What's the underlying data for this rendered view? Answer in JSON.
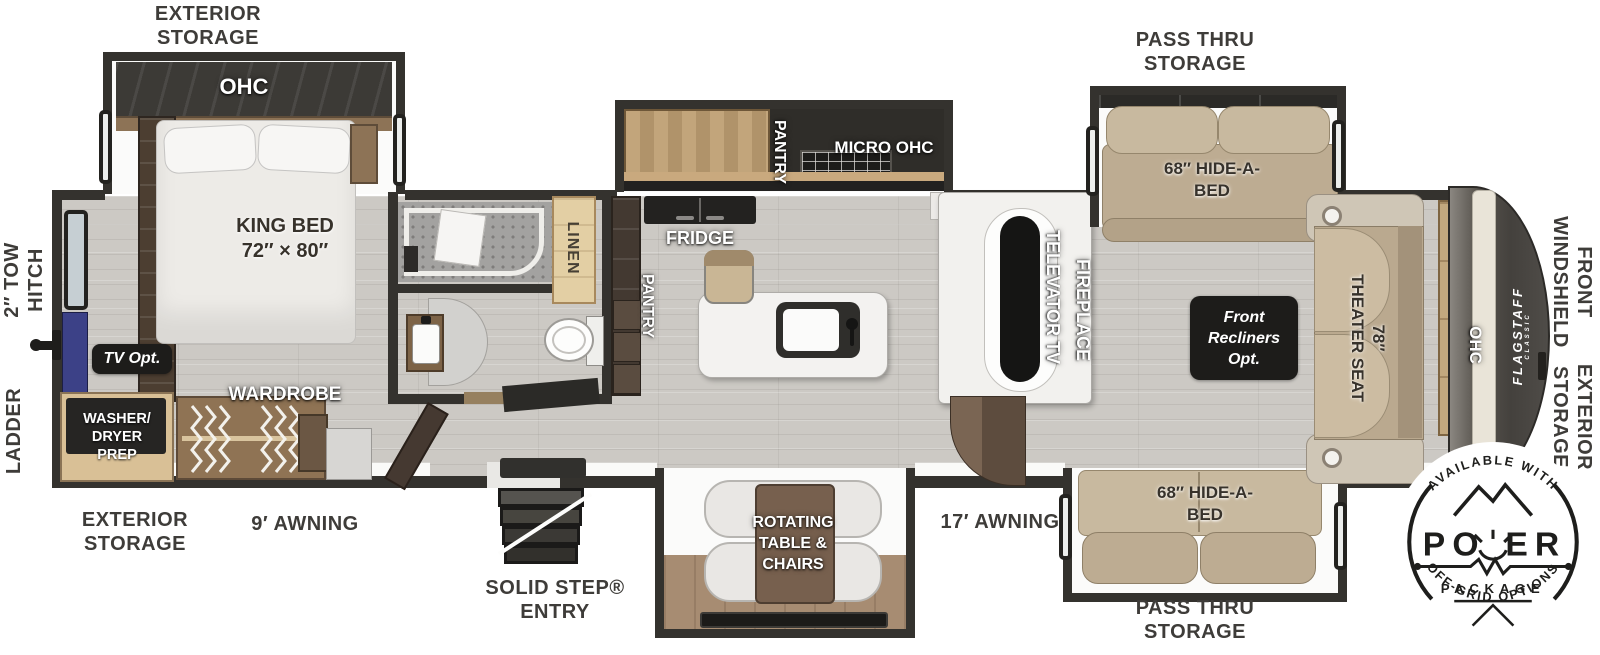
{
  "labels": {
    "exterior_storage_top": [
      "EXTERIOR",
      "STORAGE"
    ],
    "pass_thru_top": [
      "PASS THRU",
      "STORAGE"
    ],
    "tow_hitch": [
      "2″ TOW",
      "HITCH"
    ],
    "ladder": "LADDER",
    "exterior_storage_bottom": [
      "EXTERIOR",
      "STORAGE"
    ],
    "awning_9": "9′ AWNING",
    "solid_step": [
      "SOLID STEP®",
      "ENTRY"
    ],
    "awning_17": "17′ AWNING",
    "pass_thru_bottom": [
      "PASS THRU",
      "STORAGE"
    ],
    "front_windshield": [
      "FRONT",
      "WINDSHIELD"
    ],
    "exterior_storage_right": [
      "EXTERIOR",
      "STORAGE"
    ]
  },
  "bedroom": {
    "ohc": "OHC",
    "king_bed": [
      "KING BED",
      "72″ × 80″"
    ],
    "wardrobe": "WARDROBE",
    "tv_opt": "TV Opt.",
    "washer_dryer": [
      "WASHER/",
      "DRYER",
      "PREP"
    ]
  },
  "bathroom": {
    "linen": "LINEN"
  },
  "kitchen": {
    "pantry_main": "PANTRY",
    "fridge": "FRIDGE",
    "pantry_slide": "PANTRY",
    "micro_ohc": "MICRO OHC"
  },
  "living": {
    "televator_tv": "TELEVATOR TV",
    "fireplace": "FIREPLACE",
    "hide_a_bed_top": [
      "68″ HIDE-A-",
      "BED"
    ],
    "hide_a_bed_bottom": [
      "68″ HIDE-A-",
      "BED"
    ],
    "front_recliners": [
      "Front",
      "Recliners",
      "Opt."
    ],
    "theater_seat": [
      "78″",
      "THEATER SEAT"
    ],
    "ohc_front": "OHC",
    "rotating_table": [
      "ROTATING",
      "TABLE &",
      "CHAIRS"
    ]
  },
  "brand": {
    "name": "FLAGSTAFF",
    "sub": "CLASSIC"
  },
  "power_badge": {
    "available": "AVAILABLE WITH",
    "po": "PO",
    "er": "ER",
    "package": "PACKAGE",
    "offgrid": "OFF-GRID OPTIONS"
  },
  "colors": {
    "floor": "#ccc9c4",
    "wall": "#34322e",
    "slide_floor": "#fbfbfa",
    "couch_tan": "#bdac92",
    "wood_light": "#c2a57b",
    "wood_dark": "#4c3e31",
    "linen_tan": "#e3cfa4",
    "badge_black": "#1d1c1a",
    "tv_blue": "#3c4187",
    "front_cap": "#45423e",
    "label_gray": "#3e3c39"
  }
}
